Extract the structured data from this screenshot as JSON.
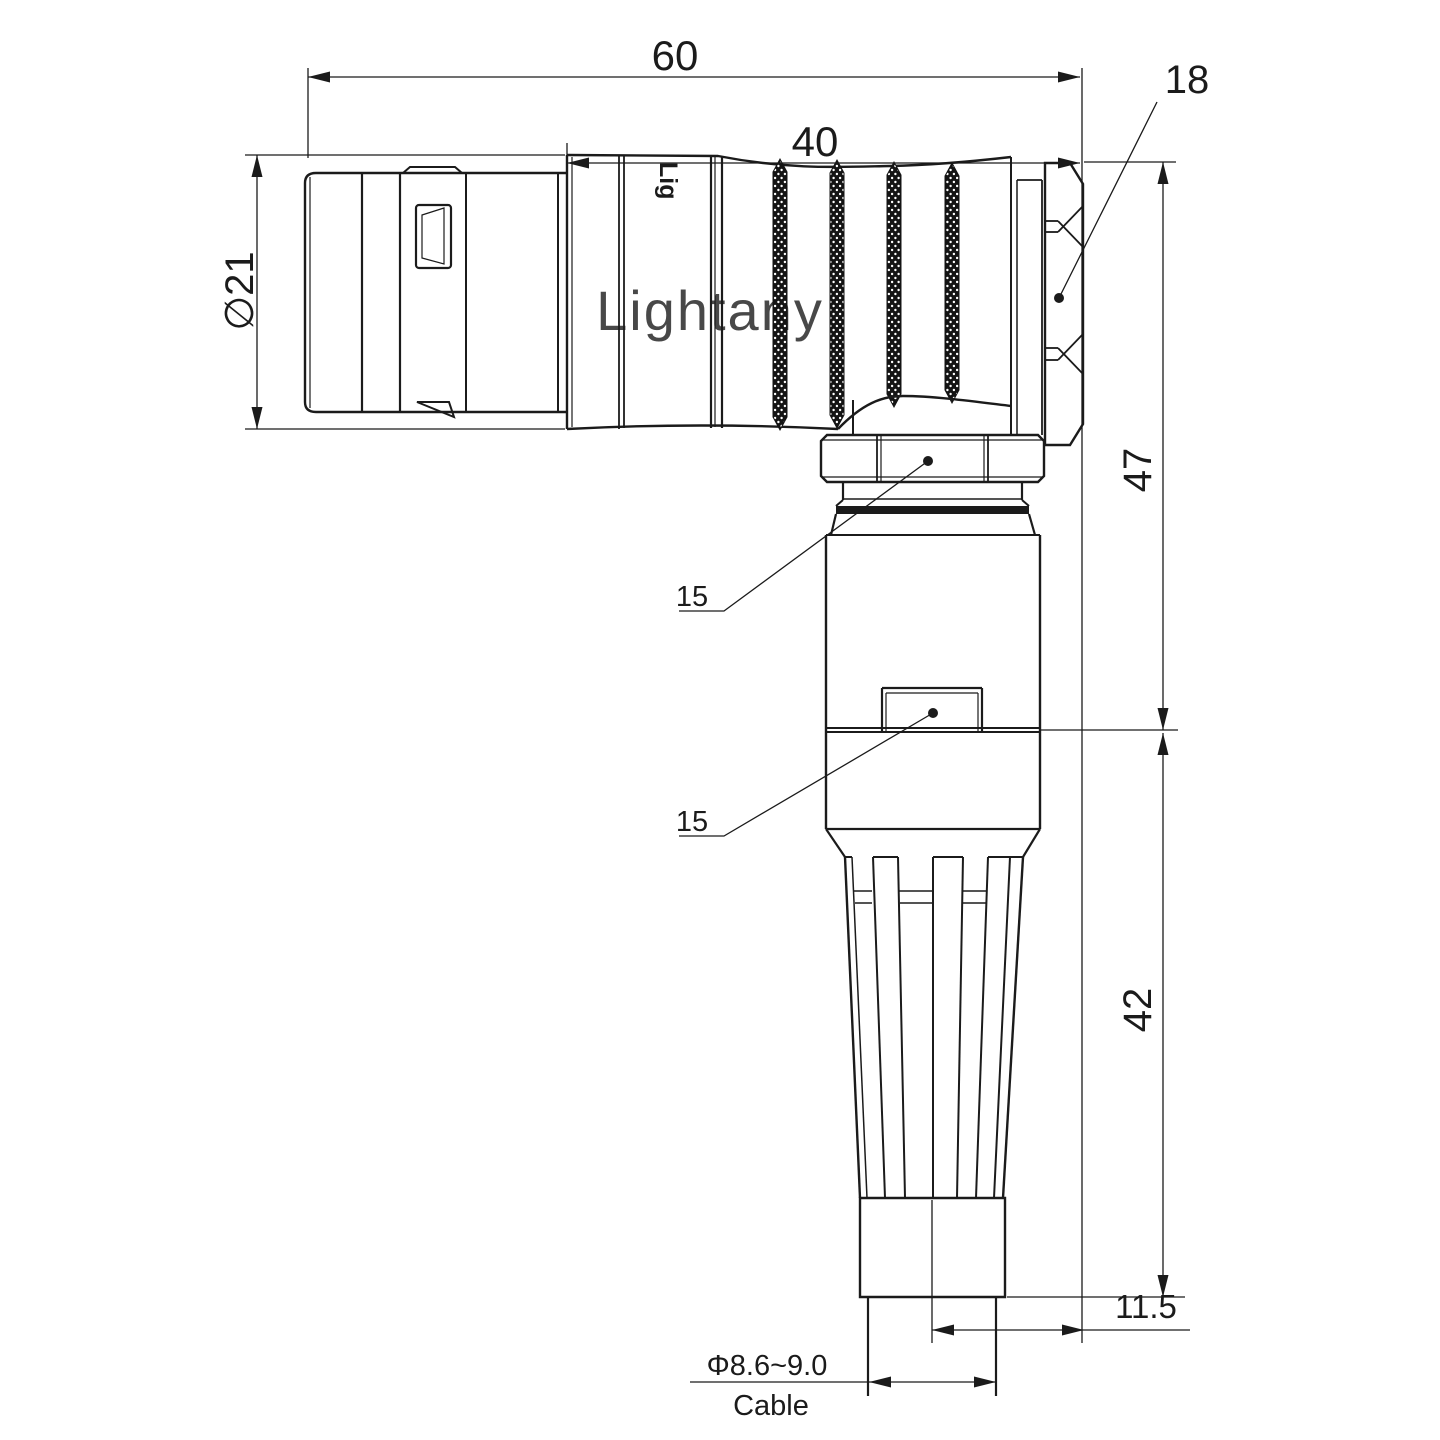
{
  "drawing": {
    "watermark_text": "Lightany",
    "body_logo_text": "Lig",
    "labels": {
      "dim_overall_length": "60",
      "dim_rear_length": "40",
      "dim_hex_nut_width": "18",
      "dim_plug_diameter": "∅21",
      "dim_height_upper": "47",
      "dim_height_lower": "42",
      "dim_cable_axis_offset": "11.5",
      "dim_coupling_nut_flats": "15",
      "dim_lower_nut_flats": "15",
      "dim_cable_diameter": "Φ8.6~9.0",
      "cable_caption": "Cable"
    },
    "colors": {
      "line": "#1b1b1b",
      "watermark": "#f5bdbd",
      "background": "#ffffff"
    }
  }
}
